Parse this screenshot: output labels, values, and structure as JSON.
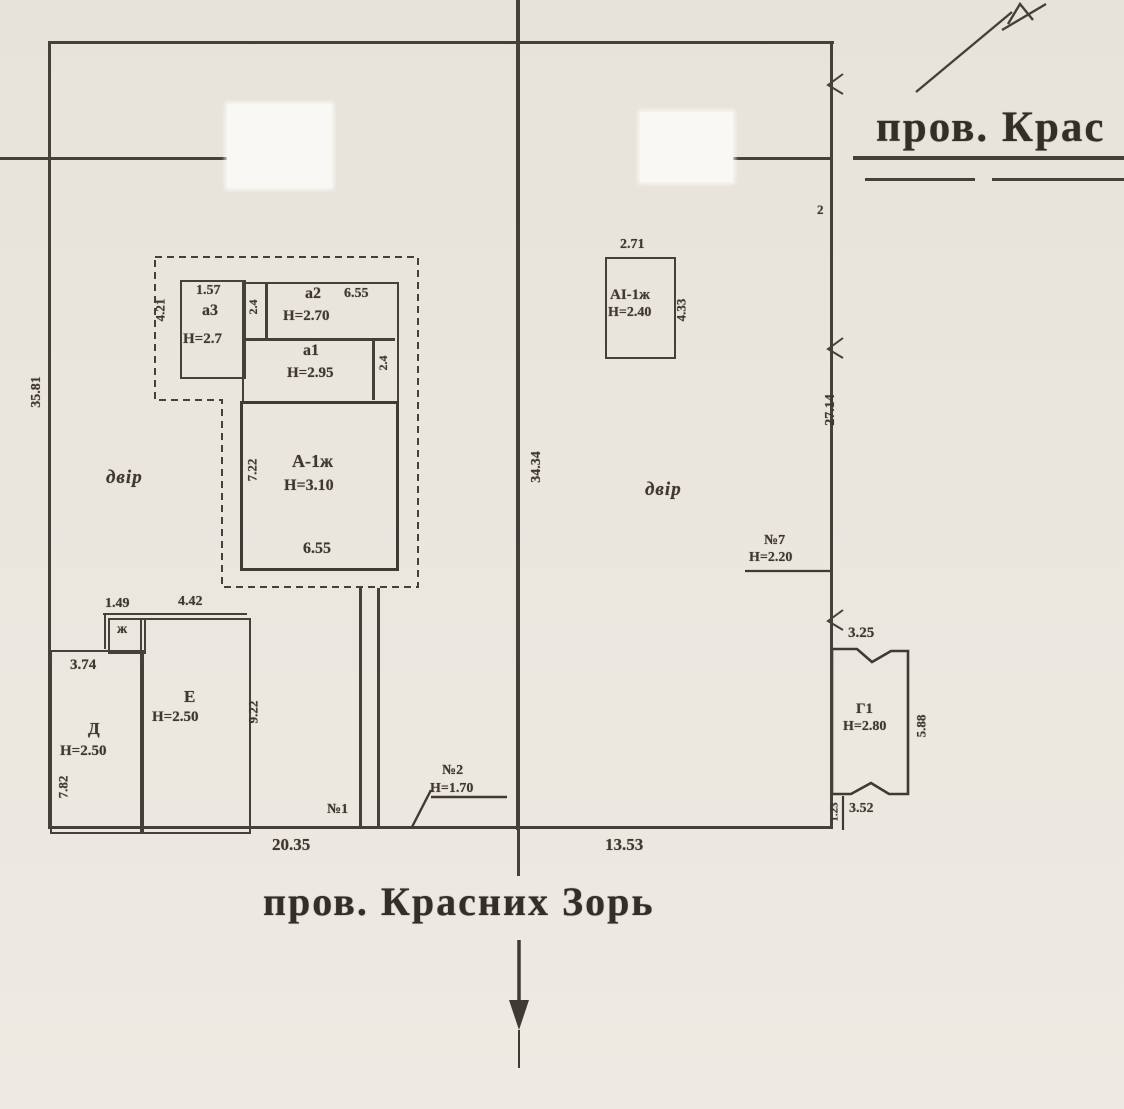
{
  "streets": {
    "top": "пров. Крас",
    "bottom": "пров. Красних Зорь"
  },
  "site": {
    "dims": {
      "left": "35.81",
      "road": "34.34",
      "right": "27.14",
      "bottom_left": "20.35",
      "bottom_right": "13.53"
    },
    "yards": {
      "left": "двір",
      "right": "двір"
    },
    "point": "2"
  },
  "complex_a": {
    "a3": {
      "name": "а3",
      "h": "Н=2.7",
      "w": "1.57",
      "side": "4.21"
    },
    "strip1": "2.4",
    "a2": {
      "name": "а2",
      "h": "Н=2.70",
      "w": "6.55"
    },
    "a1": {
      "name": "а1",
      "h": "Н=2.95"
    },
    "strip2": "2.4",
    "main": {
      "name": "А-1ж",
      "h": "Н=3.10",
      "w": "6.55",
      "side": "7.22"
    }
  },
  "bldg_ai": {
    "name": "АІ-1ж",
    "h": "Н=2.40",
    "w": "2.71",
    "side": "4.33"
  },
  "bldg_d": {
    "name": "Д",
    "h": "Н=2.50",
    "w": "3.74",
    "side": "7.82"
  },
  "bldg_e": {
    "name": "Е",
    "h": "Н=2.50",
    "w1": "1.49",
    "w2": "4.42",
    "side": "9.22"
  },
  "bldg_zh": {
    "name": "ж"
  },
  "bldg_g1": {
    "name": "Г1",
    "h": "Н=2.80",
    "top": "3.25",
    "side": "5.88",
    "bottom": "3.52",
    "notch": "1.23"
  },
  "fence7": {
    "name": "№7",
    "h": "Н=2.20"
  },
  "gate2": {
    "name": "№2",
    "h": "Н=1.70"
  },
  "gate1": {
    "name": "№1"
  }
}
